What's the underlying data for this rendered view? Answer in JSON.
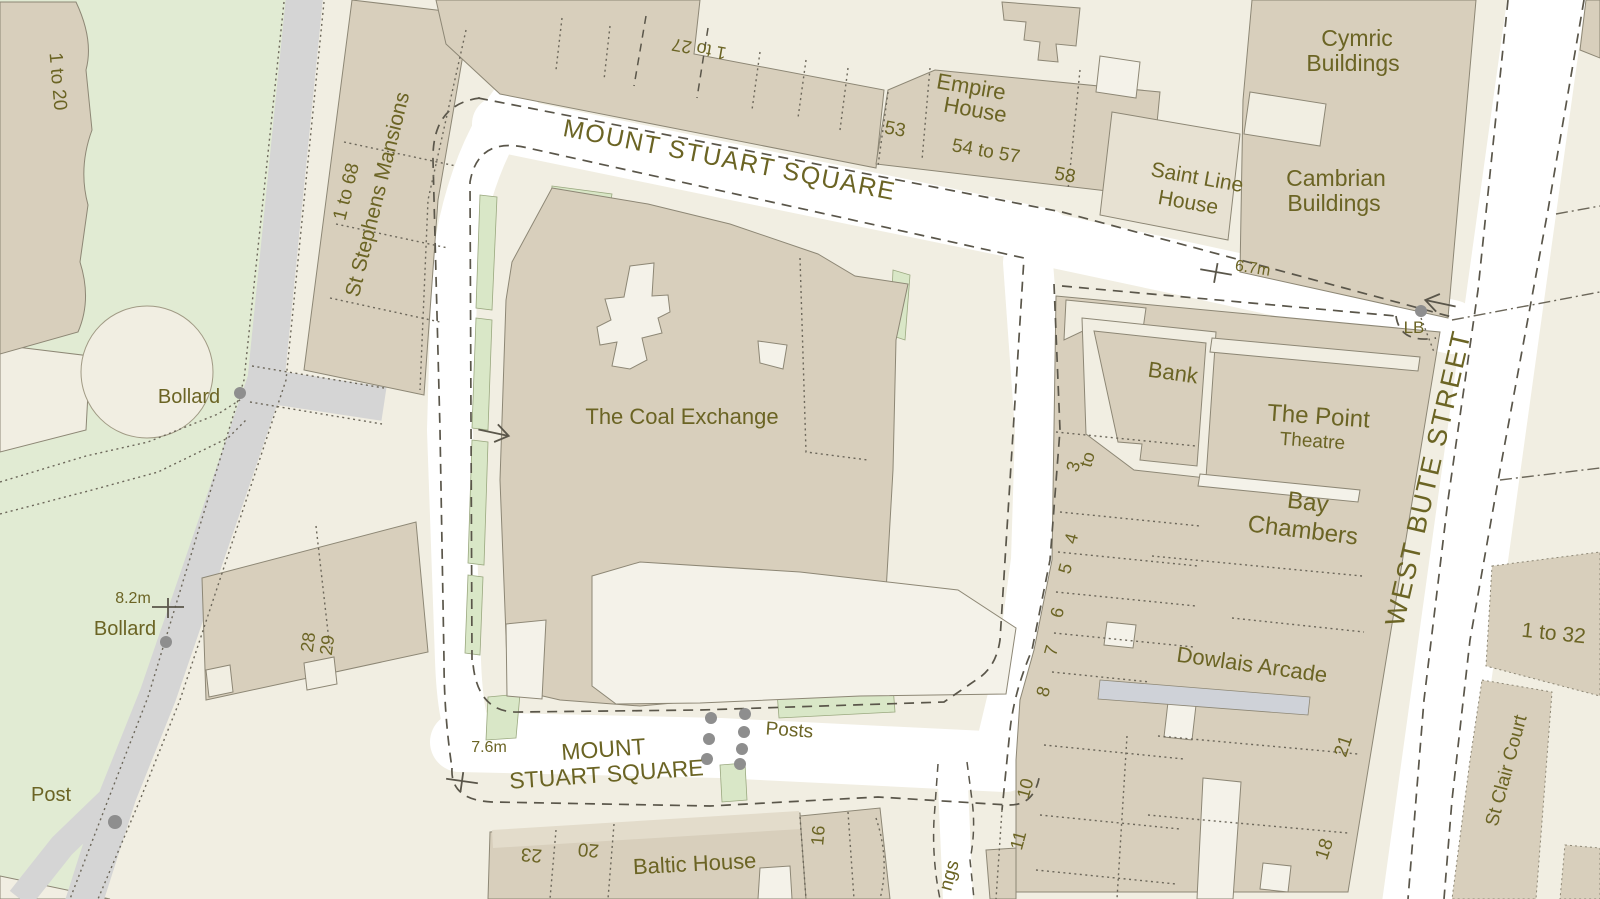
{
  "map": {
    "kind": "large-scale street map extract",
    "palette": {
      "pavement": "#f1eee2",
      "road_white": "#ffffff",
      "building": "#d8cfbc",
      "building_light": "#e7e1d2",
      "building_top": "#e3dccb",
      "court": "#f4f2e9",
      "green": "#e1ebd3",
      "green_strip": "#d9e7c7",
      "gray_road": "#d5d5d5",
      "arcade_gray": "#cfd2d8",
      "ink": "#6b6424",
      "line_dark": "#5a564a",
      "line_dot": "#6c675a",
      "building_line": "#8d8775",
      "marker_gray": "#8e8e8e"
    },
    "labels": [
      {
        "id": "street-mount-stuart-square-top",
        "text": "MOUNT STUART SQUARE",
        "x": 728,
        "y": 168,
        "r": 11,
        "s": 25,
        "ls": 1.5
      },
      {
        "id": "street-mount-stuart-square-bottom-1",
        "text": "MOUNT",
        "x": 604,
        "y": 757,
        "r": -4,
        "s": 23
      },
      {
        "id": "street-mount-stuart-square-bottom-2",
        "text": "STUART SQUARE",
        "x": 607,
        "y": 782,
        "r": -4,
        "s": 23
      },
      {
        "id": "street-west-bute-street",
        "text": "WEST BUTE STREET",
        "x": 1437,
        "y": 480,
        "r": -77,
        "s": 27,
        "ls": 2
      },
      {
        "id": "bld-coal-exchange",
        "text": "The Coal Exchange",
        "x": 682,
        "y": 424,
        "r": 0,
        "s": 22
      },
      {
        "id": "bld-empire-house-1",
        "text": "Empire",
        "x": 970,
        "y": 94,
        "r": 10,
        "s": 22
      },
      {
        "id": "bld-empire-house-2",
        "text": "House",
        "x": 974,
        "y": 117,
        "r": 10,
        "s": 22
      },
      {
        "id": "bld-saint-line-house-1",
        "text": "Saint Line",
        "x": 1196,
        "y": 184,
        "r": 10,
        "s": 21
      },
      {
        "id": "bld-saint-line-house-2",
        "text": "House",
        "x": 1187,
        "y": 209,
        "r": 10,
        "s": 21
      },
      {
        "id": "bld-cymric-buildings-1",
        "text": "Cymric",
        "x": 1357,
        "y": 46,
        "r": 0,
        "s": 23
      },
      {
        "id": "bld-cymric-buildings-2",
        "text": "Buildings",
        "x": 1353,
        "y": 71,
        "r": 0,
        "s": 23
      },
      {
        "id": "bld-cambrian-buildings-1",
        "text": "Cambrian",
        "x": 1336,
        "y": 186,
        "r": 0,
        "s": 23
      },
      {
        "id": "bld-cambrian-buildings-2",
        "text": "Buildings",
        "x": 1334,
        "y": 211,
        "r": 0,
        "s": 23
      },
      {
        "id": "bld-bank",
        "text": "Bank",
        "x": 1172,
        "y": 380,
        "r": 8,
        "s": 22
      },
      {
        "id": "bld-the-point-1",
        "text": "The Point",
        "x": 1318,
        "y": 424,
        "r": 4,
        "s": 24
      },
      {
        "id": "bld-the-point-2",
        "text": "Theatre",
        "x": 1312,
        "y": 447,
        "r": 4,
        "s": 19
      },
      {
        "id": "bld-bay-chambers-1",
        "text": "Bay",
        "x": 1307,
        "y": 510,
        "r": 7,
        "s": 24
      },
      {
        "id": "bld-bay-chambers-2",
        "text": "Chambers",
        "x": 1302,
        "y": 538,
        "r": 7,
        "s": 24
      },
      {
        "id": "bld-dowlais-arcade",
        "text": "Dowlais Arcade",
        "x": 1251,
        "y": 672,
        "r": 8,
        "s": 22
      },
      {
        "id": "bld-baltic-house",
        "text": "Baltic House",
        "x": 695,
        "y": 871,
        "r": -3,
        "s": 22
      },
      {
        "id": "bld-st-stephens-mansions-1",
        "text": "1 to 68",
        "x": 352,
        "y": 193,
        "r": -76,
        "s": 19
      },
      {
        "id": "bld-st-stephens-mansions-2",
        "text": "St Stephens Mansions",
        "x": 384,
        "y": 196,
        "r": -76,
        "s": 21
      },
      {
        "id": "bld-st-clair-court",
        "text": "St Clair Court",
        "x": 1512,
        "y": 772,
        "r": -75,
        "s": 19
      },
      {
        "id": "num-1-to-20",
        "text": "1 to 20",
        "x": 52,
        "y": 82,
        "r": 85,
        "s": 19
      },
      {
        "id": "num-1-to-27",
        "text": "1 to 27",
        "x": 700,
        "y": 43,
        "r": 190,
        "s": 18
      },
      {
        "id": "num-53",
        "text": "53",
        "x": 894,
        "y": 135,
        "r": 10,
        "s": 19
      },
      {
        "id": "num-54-to-57",
        "text": "54 to 57",
        "x": 985,
        "y": 157,
        "r": 10,
        "s": 19
      },
      {
        "id": "num-58",
        "text": "58",
        "x": 1064,
        "y": 181,
        "r": 10,
        "s": 19
      },
      {
        "id": "num-28",
        "text": "28",
        "x": 314,
        "y": 643,
        "r": -82,
        "s": 18
      },
      {
        "id": "num-29",
        "text": "29",
        "x": 333,
        "y": 646,
        "r": -82,
        "s": 18
      },
      {
        "id": "num-to",
        "text": "to",
        "x": 1093,
        "y": 461,
        "r": -75,
        "s": 18
      },
      {
        "id": "num-3",
        "text": "3",
        "x": 1079,
        "y": 468,
        "r": -75,
        "s": 18
      },
      {
        "id": "num-4",
        "text": "4",
        "x": 1077,
        "y": 540,
        "r": -75,
        "s": 18
      },
      {
        "id": "num-5",
        "text": "5",
        "x": 1071,
        "y": 570,
        "r": -75,
        "s": 18
      },
      {
        "id": "num-6",
        "text": "6",
        "x": 1063,
        "y": 614,
        "r": -75,
        "s": 18
      },
      {
        "id": "num-7",
        "text": "7",
        "x": 1057,
        "y": 652,
        "r": -75,
        "s": 18
      },
      {
        "id": "num-8",
        "text": "8",
        "x": 1049,
        "y": 693,
        "r": -75,
        "s": 18
      },
      {
        "id": "num-10",
        "text": "10",
        "x": 1031,
        "y": 790,
        "r": -75,
        "s": 18
      },
      {
        "id": "num-11",
        "text": "11",
        "x": 1024,
        "y": 842,
        "r": -75,
        "s": 18
      },
      {
        "id": "num-21",
        "text": "21",
        "x": 1349,
        "y": 748,
        "r": -72,
        "s": 19
      },
      {
        "id": "num-18",
        "text": "18",
        "x": 1330,
        "y": 851,
        "r": -72,
        "s": 19
      },
      {
        "id": "num-1-to-32",
        "text": "1 to 32",
        "x": 1553,
        "y": 640,
        "r": 6,
        "s": 21
      },
      {
        "id": "num-23",
        "text": "23",
        "x": 532,
        "y": 849,
        "r": 185,
        "s": 19
      },
      {
        "id": "num-20",
        "text": "20",
        "x": 589,
        "y": 844,
        "r": 185,
        "s": 19
      },
      {
        "id": "num-16",
        "text": "16",
        "x": 824,
        "y": 836,
        "r": -85,
        "s": 18
      },
      {
        "id": "num-ngs",
        "text": "ngs",
        "x": 955,
        "y": 877,
        "r": -75,
        "s": 19
      },
      {
        "id": "ann-bollard-top",
        "text": "Bollard",
        "x": 189,
        "y": 403,
        "r": 0,
        "s": 20
      },
      {
        "id": "ann-bollard-lower",
        "text": "Bollard",
        "x": 125,
        "y": 635,
        "r": 0,
        "s": 20
      },
      {
        "id": "ann-post",
        "text": "Post",
        "x": 51,
        "y": 801,
        "r": 0,
        "s": 20
      },
      {
        "id": "ann-posts",
        "text": "Posts",
        "x": 789,
        "y": 736,
        "r": 4,
        "s": 19
      },
      {
        "id": "ann-lb",
        "text": "LB",
        "x": 1414,
        "y": 333,
        "r": 0,
        "s": 17
      },
      {
        "id": "height-8-2m",
        "text": "8.2m",
        "x": 133,
        "y": 603,
        "r": 0,
        "s": 16
      },
      {
        "id": "height-7-6m",
        "text": "7.6m",
        "x": 489,
        "y": 752,
        "r": 0,
        "s": 16
      },
      {
        "id": "height-6-7m",
        "text": "6.7m",
        "x": 1252,
        "y": 273,
        "r": 9,
        "s": 16
      }
    ],
    "markers": {
      "dots": [
        {
          "id": "bollard-top-dot",
          "x": 240,
          "y": 393,
          "r": 6
        },
        {
          "id": "bollard-lower-dot",
          "x": 166,
          "y": 642,
          "r": 6
        },
        {
          "id": "post-dot",
          "x": 115,
          "y": 822,
          "r": 7
        },
        {
          "id": "lb-dot",
          "x": 1421,
          "y": 311,
          "r": 6
        },
        {
          "id": "posts-dot-1",
          "x": 711,
          "y": 718,
          "r": 6
        },
        {
          "id": "posts-dot-2",
          "x": 709,
          "y": 739,
          "r": 6
        },
        {
          "id": "posts-dot-3",
          "x": 707,
          "y": 759,
          "r": 6
        },
        {
          "id": "posts-dot-4",
          "x": 745,
          "y": 714,
          "r": 6
        },
        {
          "id": "posts-dot-5",
          "x": 744,
          "y": 732,
          "r": 6
        },
        {
          "id": "posts-dot-6",
          "x": 742,
          "y": 749,
          "r": 6
        },
        {
          "id": "posts-dot-7",
          "x": 740,
          "y": 764,
          "r": 6
        }
      ],
      "bench_marks": [
        {
          "id": "bm-8-2m",
          "x": 168,
          "y": 607,
          "r": 0
        },
        {
          "id": "bm-7-6m",
          "x": 462,
          "y": 781,
          "r": 8
        },
        {
          "id": "bm-6-7m",
          "x": 1216,
          "y": 272,
          "r": 10
        }
      ],
      "flow_arrows": [
        {
          "id": "arrow-west-road",
          "x": 495,
          "y": 433,
          "r": 12
        },
        {
          "id": "arrow-west-bute-street",
          "x": 1439,
          "y": 303,
          "r": 192
        }
      ]
    }
  }
}
